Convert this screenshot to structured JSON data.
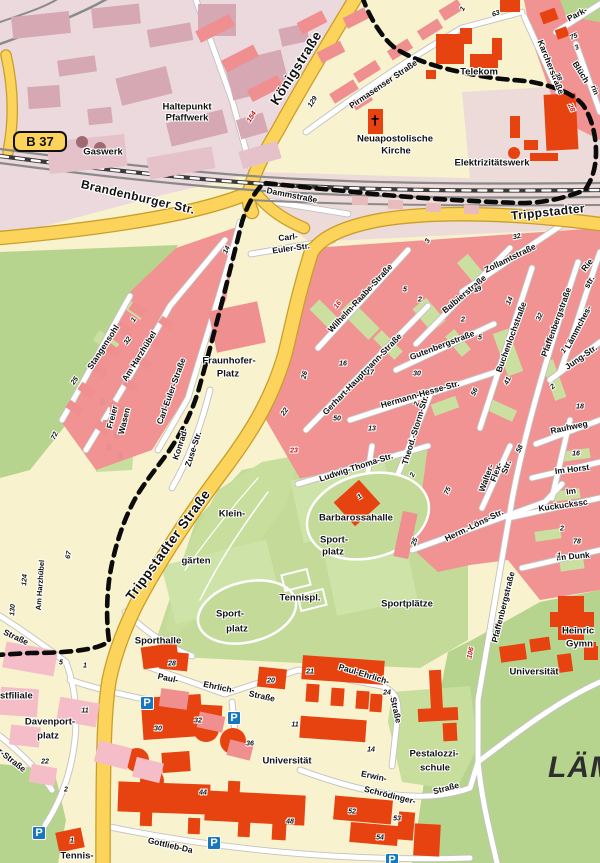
{
  "route_badge": {
    "text": "B 37"
  },
  "district_label": {
    "text": "LÄM"
  },
  "colors": {
    "bg_cream": "#F8F2CE",
    "residential_salmon": "#F09392",
    "courtyard_green": "#CBE0A0",
    "park_green": "#B7D48E",
    "field_green": "#C3DA99",
    "allotment_green": "#C7DE9C",
    "industrial_bg": "#EBD9DE",
    "industrial_building": "#D6A8B4",
    "industrial_building_light": "#E5C2CA",
    "pink_strip": "#EDDBD9",
    "pink_block_light": "#F4BDC8",
    "building_red": "#E64310",
    "road_yellow": "#FCD45C",
    "road_yellow_casing": "#C99F2B",
    "street_white": "#FFFFFF",
    "street_casing": "#C2C2C2",
    "railway_gray": "#8A8A8A",
    "boundary_black": "#0B0B0B",
    "parking_blue": "#1878BE",
    "number_red": "#C80A0A"
  },
  "labels": [
    [
      "Königstraße",
      296,
      68,
      -58,
      "road-xl"
    ],
    [
      "Brandenburger Str.",
      138,
      197,
      13,
      "road-lg"
    ],
    [
      "Trippstadter",
      548,
      212,
      -6,
      "road-lg"
    ],
    [
      "Trippstadter Straße",
      168,
      545,
      -54,
      "road-xl"
    ],
    [
      "Pirmasenser Straße",
      383,
      84,
      -34,
      "street"
    ],
    [
      "Karcherstraße",
      551,
      67,
      68,
      "street"
    ],
    [
      "Park-",
      577,
      14,
      -28,
      "street"
    ],
    [
      "Blüch",
      581,
      72,
      58,
      "street"
    ],
    [
      "rin",
      595,
      90,
      70,
      "street-sm"
    ],
    [
      "Rie",
      587,
      265,
      -52,
      "street"
    ],
    [
      "str.",
      589,
      282,
      -60,
      "street"
    ],
    [
      "Dammstraße",
      292,
      195,
      11,
      "street"
    ],
    [
      "Carl-",
      288,
      237,
      -6,
      "street"
    ],
    [
      "Euler-Str.",
      291,
      248,
      -8,
      "street"
    ],
    [
      "Carl-Euler-Straße",
      171,
      391,
      -70,
      "street"
    ],
    [
      "Konrad-",
      180,
      444,
      -72,
      "street"
    ],
    [
      "Zuse-Str.",
      193,
      449,
      -72,
      "street"
    ],
    [
      "Wilhelm-Raabe-Straße",
      360,
      298,
      -47,
      "street"
    ],
    [
      "Gerhart-Hauptmann-Straße",
      362,
      374,
      -46,
      "street"
    ],
    [
      "Balbierstraße",
      464,
      294,
      -40,
      "street"
    ],
    [
      "Zollamtstraße",
      510,
      258,
      -26,
      "street"
    ],
    [
      "Gutenbergstraße",
      442,
      345,
      -21,
      "street"
    ],
    [
      "Hermann-Hesse-Str.",
      420,
      394,
      -16,
      "street"
    ],
    [
      "Theod.-Storm-Str.",
      415,
      430,
      -73,
      "street"
    ],
    [
      "Ludwig-Thoma-Str.",
      356,
      467,
      -18,
      "street"
    ],
    [
      "Buchenlochstraße",
      511,
      337,
      -70,
      "street"
    ],
    [
      "Pfaffenbergstraße",
      556,
      322,
      -70,
      "street"
    ],
    [
      "Pfaffenbergstraße",
      503,
      607,
      -76,
      "street"
    ],
    [
      "Lämmches-",
      578,
      327,
      -62,
      "street"
    ],
    [
      "Jung-Str.",
      581,
      357,
      -35,
      "street"
    ],
    [
      "Rauhweg",
      569,
      427,
      -12,
      "street"
    ],
    [
      "Im Horst",
      572,
      469,
      -7,
      "street"
    ],
    [
      "Im",
      571,
      491,
      -7,
      "street"
    ],
    [
      "Kuckuckssc",
      563,
      505,
      -8,
      "street"
    ],
    [
      "Im Dunk",
      573,
      556,
      -5,
      "street"
    ],
    [
      "Walter-",
      486,
      478,
      -70,
      "street"
    ],
    [
      "Flex-",
      496,
      472,
      -70,
      "street"
    ],
    [
      "Str.",
      506,
      467,
      -70,
      "street"
    ],
    [
      "Herm.-Löns-Str.",
      474,
      525,
      -26,
      "street"
    ],
    [
      "Am Harzhübel",
      139,
      356,
      -58,
      "street"
    ],
    [
      "Stangensohl",
      103,
      347,
      -57,
      "street"
    ],
    [
      "Freier",
      112,
      417,
      -76,
      "street"
    ],
    [
      "Wasen",
      124,
      421,
      -76,
      "street"
    ],
    [
      "Am Harzhübel",
      40,
      585,
      -86,
      "street-sm"
    ],
    [
      "Paul-",
      168,
      678,
      12,
      "street"
    ],
    [
      "Ehrlich-",
      219,
      687,
      12,
      "street"
    ],
    [
      "Straße",
      262,
      696,
      12,
      "street"
    ],
    [
      "Paul-Ehrlich-",
      364,
      674,
      17,
      "street"
    ],
    [
      "Straße",
      396,
      710,
      77,
      "street"
    ],
    [
      "Erwin-",
      374,
      776,
      12,
      "street"
    ],
    [
      "Schrödinger-",
      390,
      795,
      14,
      "street"
    ],
    [
      "Straße",
      446,
      788,
      -15,
      "street"
    ],
    [
      "Gottlieb-Da",
      148,
      840,
      13,
      "street",
      "l"
    ],
    [
      "Straße",
      16,
      637,
      25,
      "street"
    ],
    [
      "r-Straße",
      12,
      760,
      38,
      "street"
    ],
    [
      "Haltepunkt",
      187,
      107,
      0,
      "place"
    ],
    [
      "Pfaffwerk",
      187,
      118,
      0,
      "place"
    ],
    [
      "Gaswerk",
      103,
      152,
      0,
      "place"
    ],
    [
      "Telekom",
      479,
      72,
      0,
      "place"
    ],
    [
      "Neuapostolische",
      395,
      139,
      0,
      "place"
    ],
    [
      "Kirche",
      396,
      151,
      0,
      "place"
    ],
    [
      "Elektrizitätswerk",
      492,
      163,
      0,
      "place"
    ],
    [
      "Fraunhofer-",
      229,
      361,
      0,
      "place"
    ],
    [
      "Platz",
      228,
      374,
      0,
      "place"
    ],
    [
      "Klein-",
      232,
      514,
      0,
      "place"
    ],
    [
      "gärten",
      196,
      561,
      0,
      "place"
    ],
    [
      "Barbarossahalle",
      356,
      518,
      0,
      "place"
    ],
    [
      "Sport-",
      334,
      540,
      0,
      "place"
    ],
    [
      "platz",
      333,
      552,
      0,
      "place"
    ],
    [
      "Sportplätze",
      407,
      604,
      0,
      "place"
    ],
    [
      "Tennispl.",
      300,
      598,
      0,
      "place"
    ],
    [
      "Sport-",
      230,
      614,
      0,
      "place"
    ],
    [
      "platz",
      237,
      629,
      0,
      "place"
    ],
    [
      "Sporthalle",
      158,
      641,
      0,
      "place"
    ],
    [
      "Universität",
      287,
      761,
      0,
      "place"
    ],
    [
      "Universität",
      534,
      672,
      0,
      "place"
    ],
    [
      "Pestalozzi-",
      434,
      754,
      0,
      "place"
    ],
    [
      "schule",
      435,
      768,
      0,
      "place"
    ],
    [
      "Heinric",
      562,
      631,
      0,
      "place",
      "l"
    ],
    [
      "Gymn",
      566,
      644,
      0,
      "place",
      "l"
    ],
    [
      "Davenport-",
      50,
      722,
      0,
      "place"
    ],
    [
      "platz",
      48,
      736,
      0,
      "place"
    ],
    [
      "stfiliale",
      0,
      696,
      0,
      "place",
      "l"
    ],
    [
      "Tennis-",
      77,
      856,
      0,
      "place"
    ]
  ],
  "numbers": [
    [
      "154",
      252,
      117,
      -58,
      "r"
    ],
    [
      "129",
      313,
      102,
      -58
    ],
    [
      "63",
      496,
      14,
      -20
    ],
    [
      "1",
      463,
      9,
      -58
    ],
    [
      "75",
      574,
      37,
      -25
    ],
    [
      "3",
      577,
      48,
      -25
    ],
    [
      "38",
      558,
      77,
      65
    ],
    [
      "28",
      571,
      108,
      65,
      "r"
    ],
    [
      "32",
      517,
      237,
      -12
    ],
    [
      "3",
      428,
      241,
      -65
    ],
    [
      "5",
      405,
      290,
      0
    ],
    [
      "2",
      420,
      300,
      0
    ],
    [
      "16",
      338,
      305,
      -55,
      "r"
    ],
    [
      "49",
      478,
      290,
      -30
    ],
    [
      "14",
      510,
      301,
      -65
    ],
    [
      "32",
      540,
      317,
      -65
    ],
    [
      "2",
      463,
      320,
      0
    ],
    [
      "5",
      480,
      338,
      0
    ],
    [
      "26",
      305,
      375,
      -78
    ],
    [
      "16",
      343,
      364,
      0
    ],
    [
      "17",
      370,
      373,
      0
    ],
    [
      "30",
      417,
      374,
      0
    ],
    [
      "41",
      508,
      381,
      -65
    ],
    [
      "56",
      475,
      392,
      -65
    ],
    [
      "50",
      337,
      419,
      0
    ],
    [
      "13",
      372,
      429,
      0
    ],
    [
      "2",
      417,
      404,
      -70
    ],
    [
      "1",
      564,
      351,
      -55
    ],
    [
      "2",
      553,
      387,
      -40
    ],
    [
      "18",
      580,
      407,
      0
    ],
    [
      "22",
      285,
      412,
      -55
    ],
    [
      "23",
      294,
      451,
      0,
      "r"
    ],
    [
      "25",
      75,
      381,
      -55
    ],
    [
      "72",
      55,
      436,
      -65
    ],
    [
      "32",
      128,
      341,
      -55
    ],
    [
      "1",
      134,
      320,
      -55
    ],
    [
      "14",
      227,
      250,
      -65
    ],
    [
      "67",
      69,
      555,
      -80
    ],
    [
      "124",
      25,
      580,
      -86
    ],
    [
      "130",
      13,
      610,
      -86
    ],
    [
      "5",
      61,
      663,
      0
    ],
    [
      "1",
      85,
      666,
      0
    ],
    [
      "11",
      85,
      711,
      0
    ],
    [
      "22",
      45,
      762,
      0
    ],
    [
      "2",
      66,
      790,
      0
    ],
    [
      "28",
      172,
      664,
      0
    ],
    [
      "20",
      271,
      681,
      0
    ],
    [
      "30",
      158,
      729,
      0
    ],
    [
      "32",
      198,
      721,
      0
    ],
    [
      "36",
      250,
      744,
      0
    ],
    [
      "11",
      295,
      725,
      0
    ],
    [
      "14",
      371,
      750,
      0
    ],
    [
      "44",
      203,
      793,
      0
    ],
    [
      "48",
      290,
      822,
      0
    ],
    [
      "1",
      72,
      841,
      0
    ],
    [
      "21",
      310,
      672,
      0
    ],
    [
      "24",
      387,
      693,
      0
    ],
    [
      "52",
      352,
      812,
      0
    ],
    [
      "53",
      397,
      819,
      0
    ],
    [
      "54",
      380,
      838,
      0
    ],
    [
      "106",
      471,
      653,
      -78,
      "r"
    ],
    [
      "16",
      576,
      454,
      0
    ],
    [
      "58",
      520,
      449,
      -65
    ],
    [
      "78",
      577,
      542,
      0
    ],
    [
      "2",
      562,
      529,
      0
    ],
    [
      "1",
      559,
      556,
      0
    ],
    [
      "25",
      415,
      542,
      -70
    ],
    [
      "1",
      360,
      497,
      -35
    ],
    [
      "75",
      448,
      491,
      -65
    ],
    [
      "2",
      413,
      475,
      -65
    ]
  ],
  "icons": {
    "parking_label": "P",
    "parking": [
      [
        147,
        703
      ],
      [
        234,
        718
      ],
      [
        39,
        833
      ],
      [
        214,
        843
      ],
      [
        392,
        860
      ]
    ],
    "church": [
      375,
      121
    ]
  }
}
